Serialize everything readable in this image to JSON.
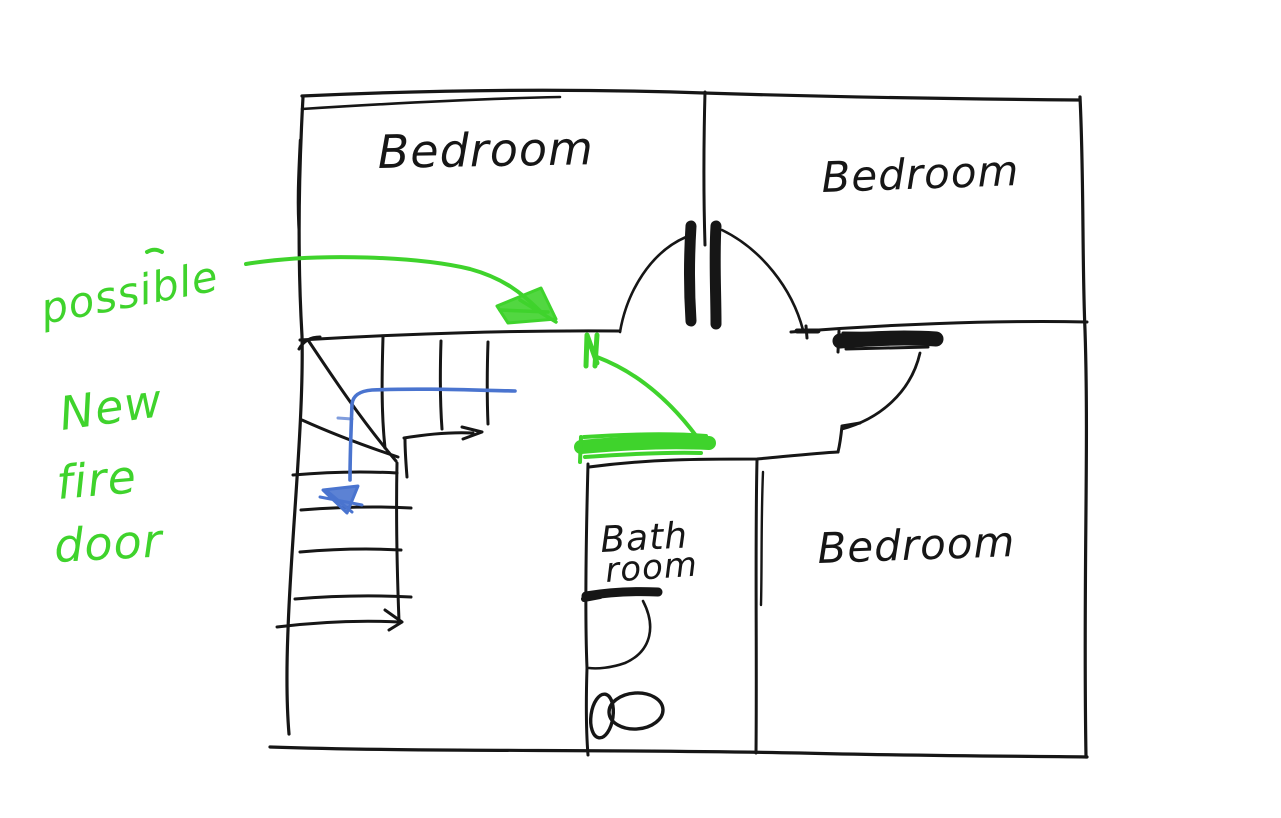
{
  "palette": {
    "ink": "#161616",
    "annotation_green": "#3fd32c",
    "annotation_blue": "#4a74cf",
    "background": "#ffffff"
  },
  "rooms": {
    "bedroom_top_left": {
      "label": "Bedroom"
    },
    "bedroom_top_right": {
      "label": "Bedroom"
    },
    "bedroom_bottom_right": {
      "label": "Bedroom"
    },
    "bathroom": {
      "label_line1": "Bath",
      "label_line2": "room"
    }
  },
  "annotations": {
    "fire_door_note": {
      "lines": [
        "possible",
        "New",
        "fire",
        "door"
      ]
    }
  }
}
